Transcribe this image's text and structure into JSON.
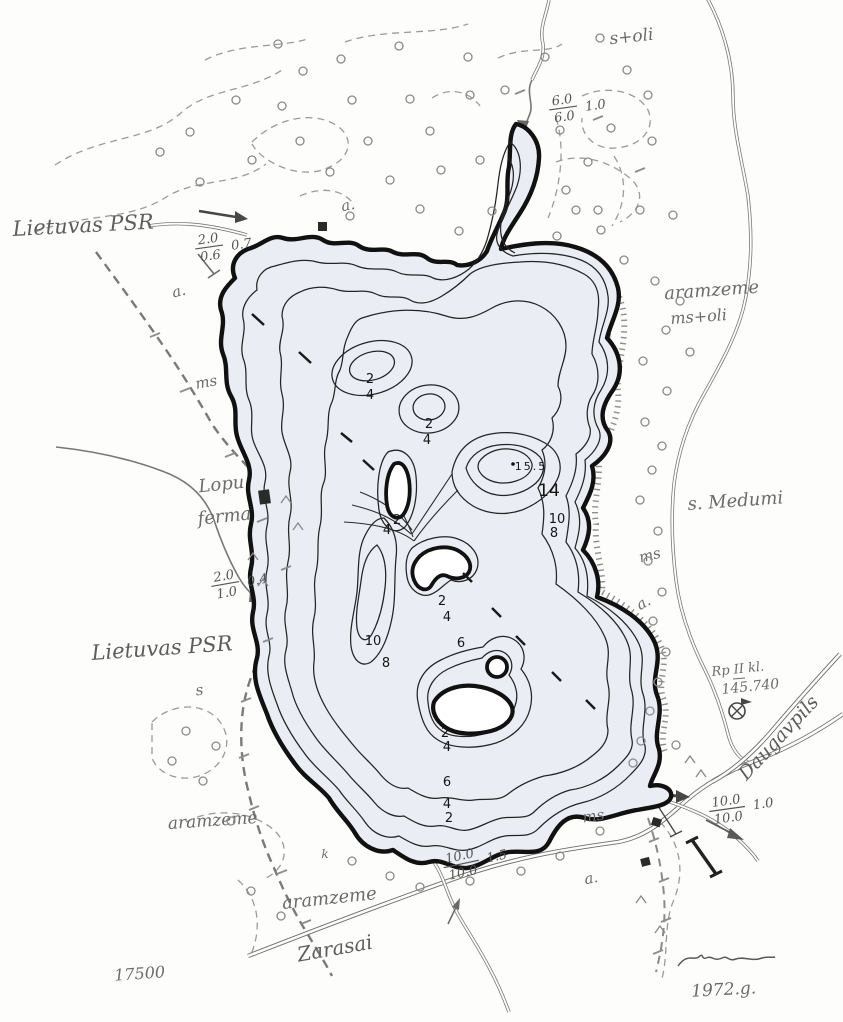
{
  "map": {
    "region_labels": {
      "lietuvas_top": "Lietuvas PSR",
      "lietuvas_bottom": "Lietuvas PSR",
      "s_oli": "s+oli",
      "aramzeme_e1": "aramzeme",
      "aramzeme_e2": "ms+oli",
      "aramzeme_sw": "aramzeme",
      "aramzeme_s": "aramzeme",
      "s_medumi": "s. Medumi",
      "lopu": "Lopu",
      "ferma": "ferma",
      "ms_w": "ms",
      "ms_e": "ms",
      "ms_s": "ms",
      "a_n": "a.",
      "a_w": "a.",
      "a_e": "a.",
      "a_s": "a.",
      "s_w": "s",
      "k_mark": "k",
      "zarasai": "Zarasai",
      "daugavpils": "Daugavpils",
      "benchmark_line1": "Rp II kl.",
      "benchmark_line2": "145.740",
      "scale": "17500",
      "year": "1972.g."
    },
    "flows": {
      "north": {
        "num": "6.0",
        "den": "6.0",
        "side": "1.0"
      },
      "northwest": {
        "num": "2.0",
        "den": "0.6",
        "side": "0.7"
      },
      "west": {
        "num": "2.0",
        "den": "1.0",
        "side": "0.4"
      },
      "south": {
        "num": "10.0",
        "den": "10.0",
        "side": "1.5"
      },
      "outflow": {
        "num": "10.0",
        "den": "10.0",
        "side": "1.0"
      }
    },
    "depths": {
      "shoal1_2": "2",
      "shoal1_4": "4",
      "shoal2_2": "2",
      "shoal2_4": "4",
      "narrows_2": "2",
      "narrows_4": "4",
      "deep_max": "15.5",
      "deep_14": "14",
      "deep_10": "10",
      "deep_8": "8",
      "mid_2": "2",
      "mid_4": "4",
      "mid_6": "6",
      "west_10": "10",
      "west_8": "8",
      "south_2": "2",
      "south_4": "4",
      "south_6": "6",
      "south_low_4": "4",
      "south_low_2": "2"
    },
    "colors": {
      "band_0_2m": "#eaeef4",
      "band_2_4m": "#dde6f2",
      "band_4_6m": "#cbdaee",
      "band_6_8m": "#b9cdea",
      "band_8_10m": "#a8c2e5",
      "band_10_14m": "#98b7e0",
      "band_14m_plus": "#87abd9",
      "shore_ink": "#111111",
      "pencil": "#5d5d5d"
    }
  }
}
